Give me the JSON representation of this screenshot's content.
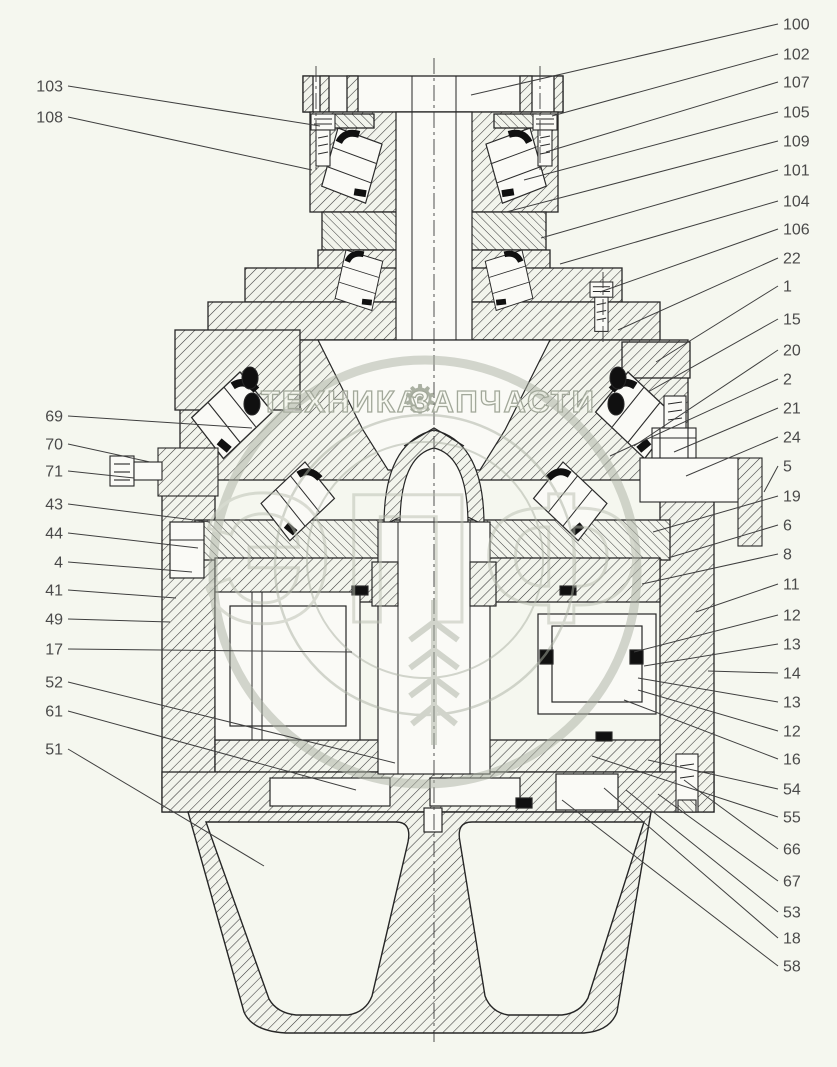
{
  "meta": {
    "kind": "technical cross-section parts diagram",
    "description": "Sectional drawing of a wheel reducer / final drive assembly with numbered part callouts"
  },
  "colors": {
    "background": "#f5f7ef",
    "line": "#262626",
    "hatch": "#3a3a3a",
    "watermark": "#b2b7aa",
    "callout_text": "#4a4a4a"
  },
  "watermark": {
    "left": "ТЕХНИКА",
    "gear": "⚙",
    "right": "ЗАПЧАСТИ",
    "big_letters": "ЭПФ"
  },
  "callouts": {
    "left": [
      {
        "label": "103",
        "y": 86,
        "px": 320,
        "py": 126
      },
      {
        "label": "108",
        "y": 117,
        "px": 312,
        "py": 170
      },
      {
        "label": "69",
        "y": 416,
        "px": 252,
        "py": 428
      },
      {
        "label": "70",
        "y": 444,
        "px": 150,
        "py": 462
      },
      {
        "label": "71",
        "y": 471,
        "px": 134,
        "py": 478
      },
      {
        "label": "43",
        "y": 504,
        "px": 210,
        "py": 522
      },
      {
        "label": "44",
        "y": 533,
        "px": 198,
        "py": 548
      },
      {
        "label": "4",
        "y": 562,
        "px": 192,
        "py": 572
      },
      {
        "label": "41",
        "y": 590,
        "px": 176,
        "py": 598
      },
      {
        "label": "49",
        "y": 619,
        "px": 170,
        "py": 622
      },
      {
        "label": "17",
        "y": 649,
        "px": 352,
        "py": 652
      },
      {
        "label": "52",
        "y": 682,
        "px": 395,
        "py": 763
      },
      {
        "label": "61",
        "y": 711,
        "px": 356,
        "py": 790
      },
      {
        "label": "51",
        "y": 749,
        "px": 264,
        "py": 866
      }
    ],
    "right": [
      {
        "label": "100",
        "y": 24,
        "px": 471,
        "py": 95
      },
      {
        "label": "102",
        "y": 54,
        "px": 552,
        "py": 116
      },
      {
        "label": "107",
        "y": 82,
        "px": 546,
        "py": 152
      },
      {
        "label": "105",
        "y": 112,
        "px": 524,
        "py": 180
      },
      {
        "label": "109",
        "y": 141,
        "px": 506,
        "py": 212
      },
      {
        "label": "101",
        "y": 170,
        "px": 541,
        "py": 238
      },
      {
        "label": "104",
        "y": 201,
        "px": 560,
        "py": 264
      },
      {
        "label": "106",
        "y": 229,
        "px": 600,
        "py": 292
      },
      {
        "label": "22",
        "y": 258,
        "px": 618,
        "py": 330
      },
      {
        "label": "1",
        "y": 286,
        "px": 656,
        "py": 362
      },
      {
        "label": "15",
        "y": 319,
        "px": 648,
        "py": 392
      },
      {
        "label": "20",
        "y": 350,
        "px": 634,
        "py": 446
      },
      {
        "label": "2",
        "y": 379,
        "px": 610,
        "py": 456
      },
      {
        "label": "21",
        "y": 408,
        "px": 674,
        "py": 452
      },
      {
        "label": "24",
        "y": 437,
        "px": 686,
        "py": 476
      },
      {
        "label": "5",
        "y": 466,
        "px": 764,
        "py": 492
      },
      {
        "label": "19",
        "y": 496,
        "px": 653,
        "py": 532
      },
      {
        "label": "6",
        "y": 525,
        "px": 668,
        "py": 558
      },
      {
        "label": "8",
        "y": 554,
        "px": 642,
        "py": 584
      },
      {
        "label": "11",
        "y": 584,
        "px": 696,
        "py": 612
      },
      {
        "label": "12",
        "y": 615,
        "px": 634,
        "py": 652
      },
      {
        "label": "13",
        "y": 644,
        "px": 644,
        "py": 666
      },
      {
        "label": "14",
        "y": 673,
        "px": 708,
        "py": 671
      },
      {
        "label": "13",
        "y": 702,
        "px": 638,
        "py": 678
      },
      {
        "label": "12",
        "y": 731,
        "px": 638,
        "py": 690
      },
      {
        "label": "16",
        "y": 759,
        "px": 624,
        "py": 700
      },
      {
        "label": "54",
        "y": 789,
        "px": 648,
        "py": 760
      },
      {
        "label": "55",
        "y": 817,
        "px": 592,
        "py": 756
      },
      {
        "label": "66",
        "y": 849,
        "px": 684,
        "py": 780
      },
      {
        "label": "67",
        "y": 881,
        "px": 658,
        "py": 794
      },
      {
        "label": "53",
        "y": 912,
        "px": 626,
        "py": 790
      },
      {
        "label": "18",
        "y": 938,
        "px": 604,
        "py": 788
      },
      {
        "label": "58",
        "y": 966,
        "px": 562,
        "py": 800
      }
    ]
  }
}
